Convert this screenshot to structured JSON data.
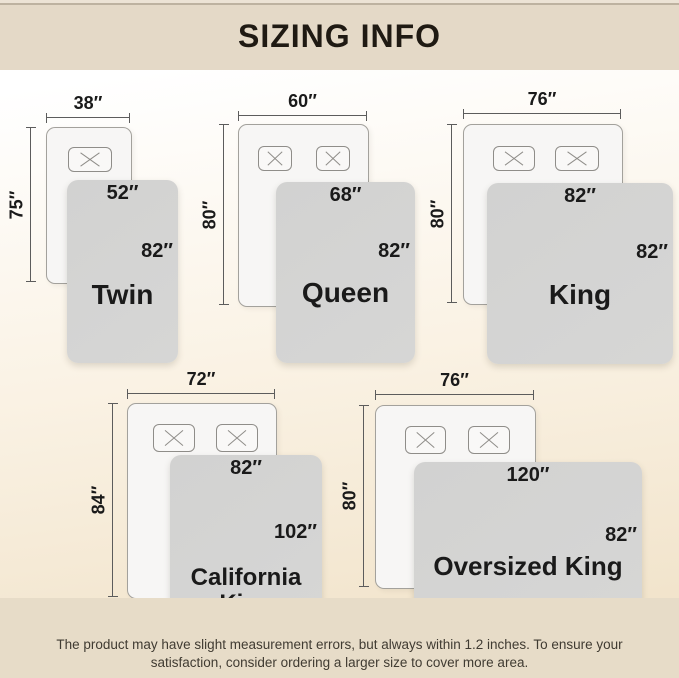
{
  "header": {
    "title": "SIZING INFO"
  },
  "sizes": [
    {
      "name": "Twin",
      "mattress_width": "38″",
      "mattress_length": "75″",
      "blanket_width": "52″",
      "blanket_length": "82″"
    },
    {
      "name": "Queen",
      "mattress_width": "60″",
      "mattress_length": "80″",
      "blanket_width": "68″",
      "blanket_length": "82″"
    },
    {
      "name": "King",
      "mattress_width": "76″",
      "mattress_length": "80″",
      "blanket_width": "82″",
      "blanket_length": "82″"
    },
    {
      "name": "California King",
      "mattress_width": "72″",
      "mattress_length": "84″",
      "blanket_width": "82″",
      "blanket_length": "102″"
    },
    {
      "name": "Oversized King",
      "mattress_width": "76″",
      "mattress_length": "80″",
      "blanket_width": "120″",
      "blanket_length": "82″"
    }
  ],
  "footer": {
    "line1": "The product may have slight measurement errors, but always within 1.2 inches. To ensure your",
    "line2": "satisfaction, consider ordering a larger size to cover more area."
  },
  "colors": {
    "band": "#e4d9c7",
    "footer_band": "#e7dcc8",
    "blanket": "#d4d4d3",
    "mattress": "#f7f6f5",
    "text": "#1a1a1a"
  }
}
